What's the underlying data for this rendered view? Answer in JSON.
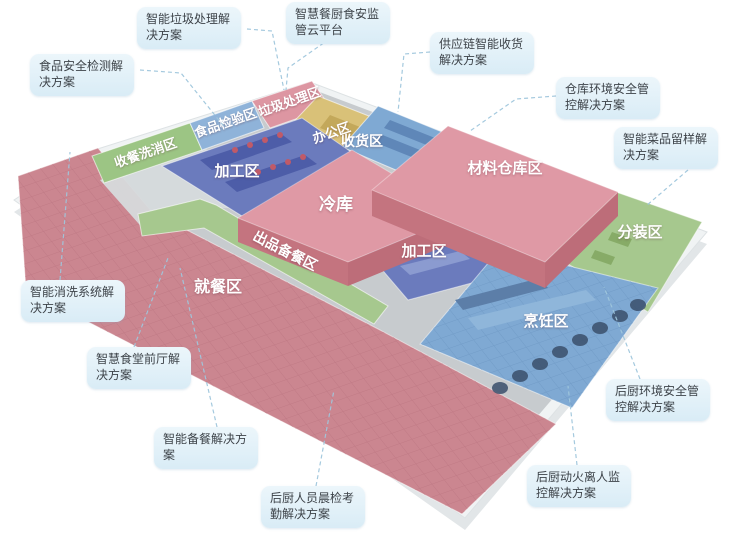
{
  "diagram": {
    "kind": "isometric-floor-plan",
    "subject": "smart-canteen-kitchen-solution-map"
  },
  "palette": {
    "background": "#ffffff",
    "callout_bg": "#e3f1f9",
    "callout_text": "#3d4349",
    "connector_line": "#9fc6dc",
    "zone_pink_floor": "#cb8690",
    "roof_pink": "#df99a5",
    "roof_pink_side": "#c4747f",
    "zone_blue": "#7fa9d3",
    "zone_indigo": "#6b7bbd",
    "zone_green": "#a6c88e",
    "zone_yellow": "#d9c178",
    "floor_gray": "#c7cbce",
    "platform_white": "#f0f3f4",
    "zone_label_text": "#ffffff"
  },
  "zones": [
    {
      "id": "dish-return-washing",
      "label": "收餐洗消区"
    },
    {
      "id": "food-inspection",
      "label": "食品检验区"
    },
    {
      "id": "garbage-processing",
      "label": "垃圾处理区"
    },
    {
      "id": "office",
      "label": "办公区"
    },
    {
      "id": "receiving",
      "label": "收货区"
    },
    {
      "id": "material-warehouse",
      "label": "材料仓库区"
    },
    {
      "id": "processing-north",
      "label": "加工区"
    },
    {
      "id": "cold-storage",
      "label": "冷库"
    },
    {
      "id": "processing-central",
      "label": "加工区"
    },
    {
      "id": "serving-prep-corridor",
      "label": "出品备餐区"
    },
    {
      "id": "dining-area",
      "label": "就餐区"
    },
    {
      "id": "portioning",
      "label": "分装区"
    },
    {
      "id": "cooking",
      "label": "烹饪区"
    }
  ],
  "callouts": [
    {
      "id": "food-safety-testing",
      "text": "食品安全检测解决方案"
    },
    {
      "id": "smart-garbage",
      "text": "智能垃圾处理解决方案"
    },
    {
      "id": "food-safety-cloud-platform",
      "text": "智慧餐厨食安监管云平台"
    },
    {
      "id": "supply-chain-receiving",
      "text": "供应链智能收货解决方案"
    },
    {
      "id": "warehouse-env-safety",
      "text": "仓库环境安全管控解决方案"
    },
    {
      "id": "dish-sample-retention",
      "text": "智能菜品留样解决方案"
    },
    {
      "id": "smart-washing-system",
      "text": "智能消洗系统解决方案"
    },
    {
      "id": "smart-canteen-front-hall",
      "text": "智慧食堂前厅解决方案"
    },
    {
      "id": "smart-meal-prep",
      "text": "智能备餐解决方案"
    },
    {
      "id": "staff-morning-check",
      "text": "后厨人员晨检考勤解决方案"
    },
    {
      "id": "fire-unattended-monitor",
      "text": "后厨动火离人监控解决方案"
    },
    {
      "id": "kitchen-env-safety",
      "text": "后厨环境安全管控解决方案"
    }
  ]
}
